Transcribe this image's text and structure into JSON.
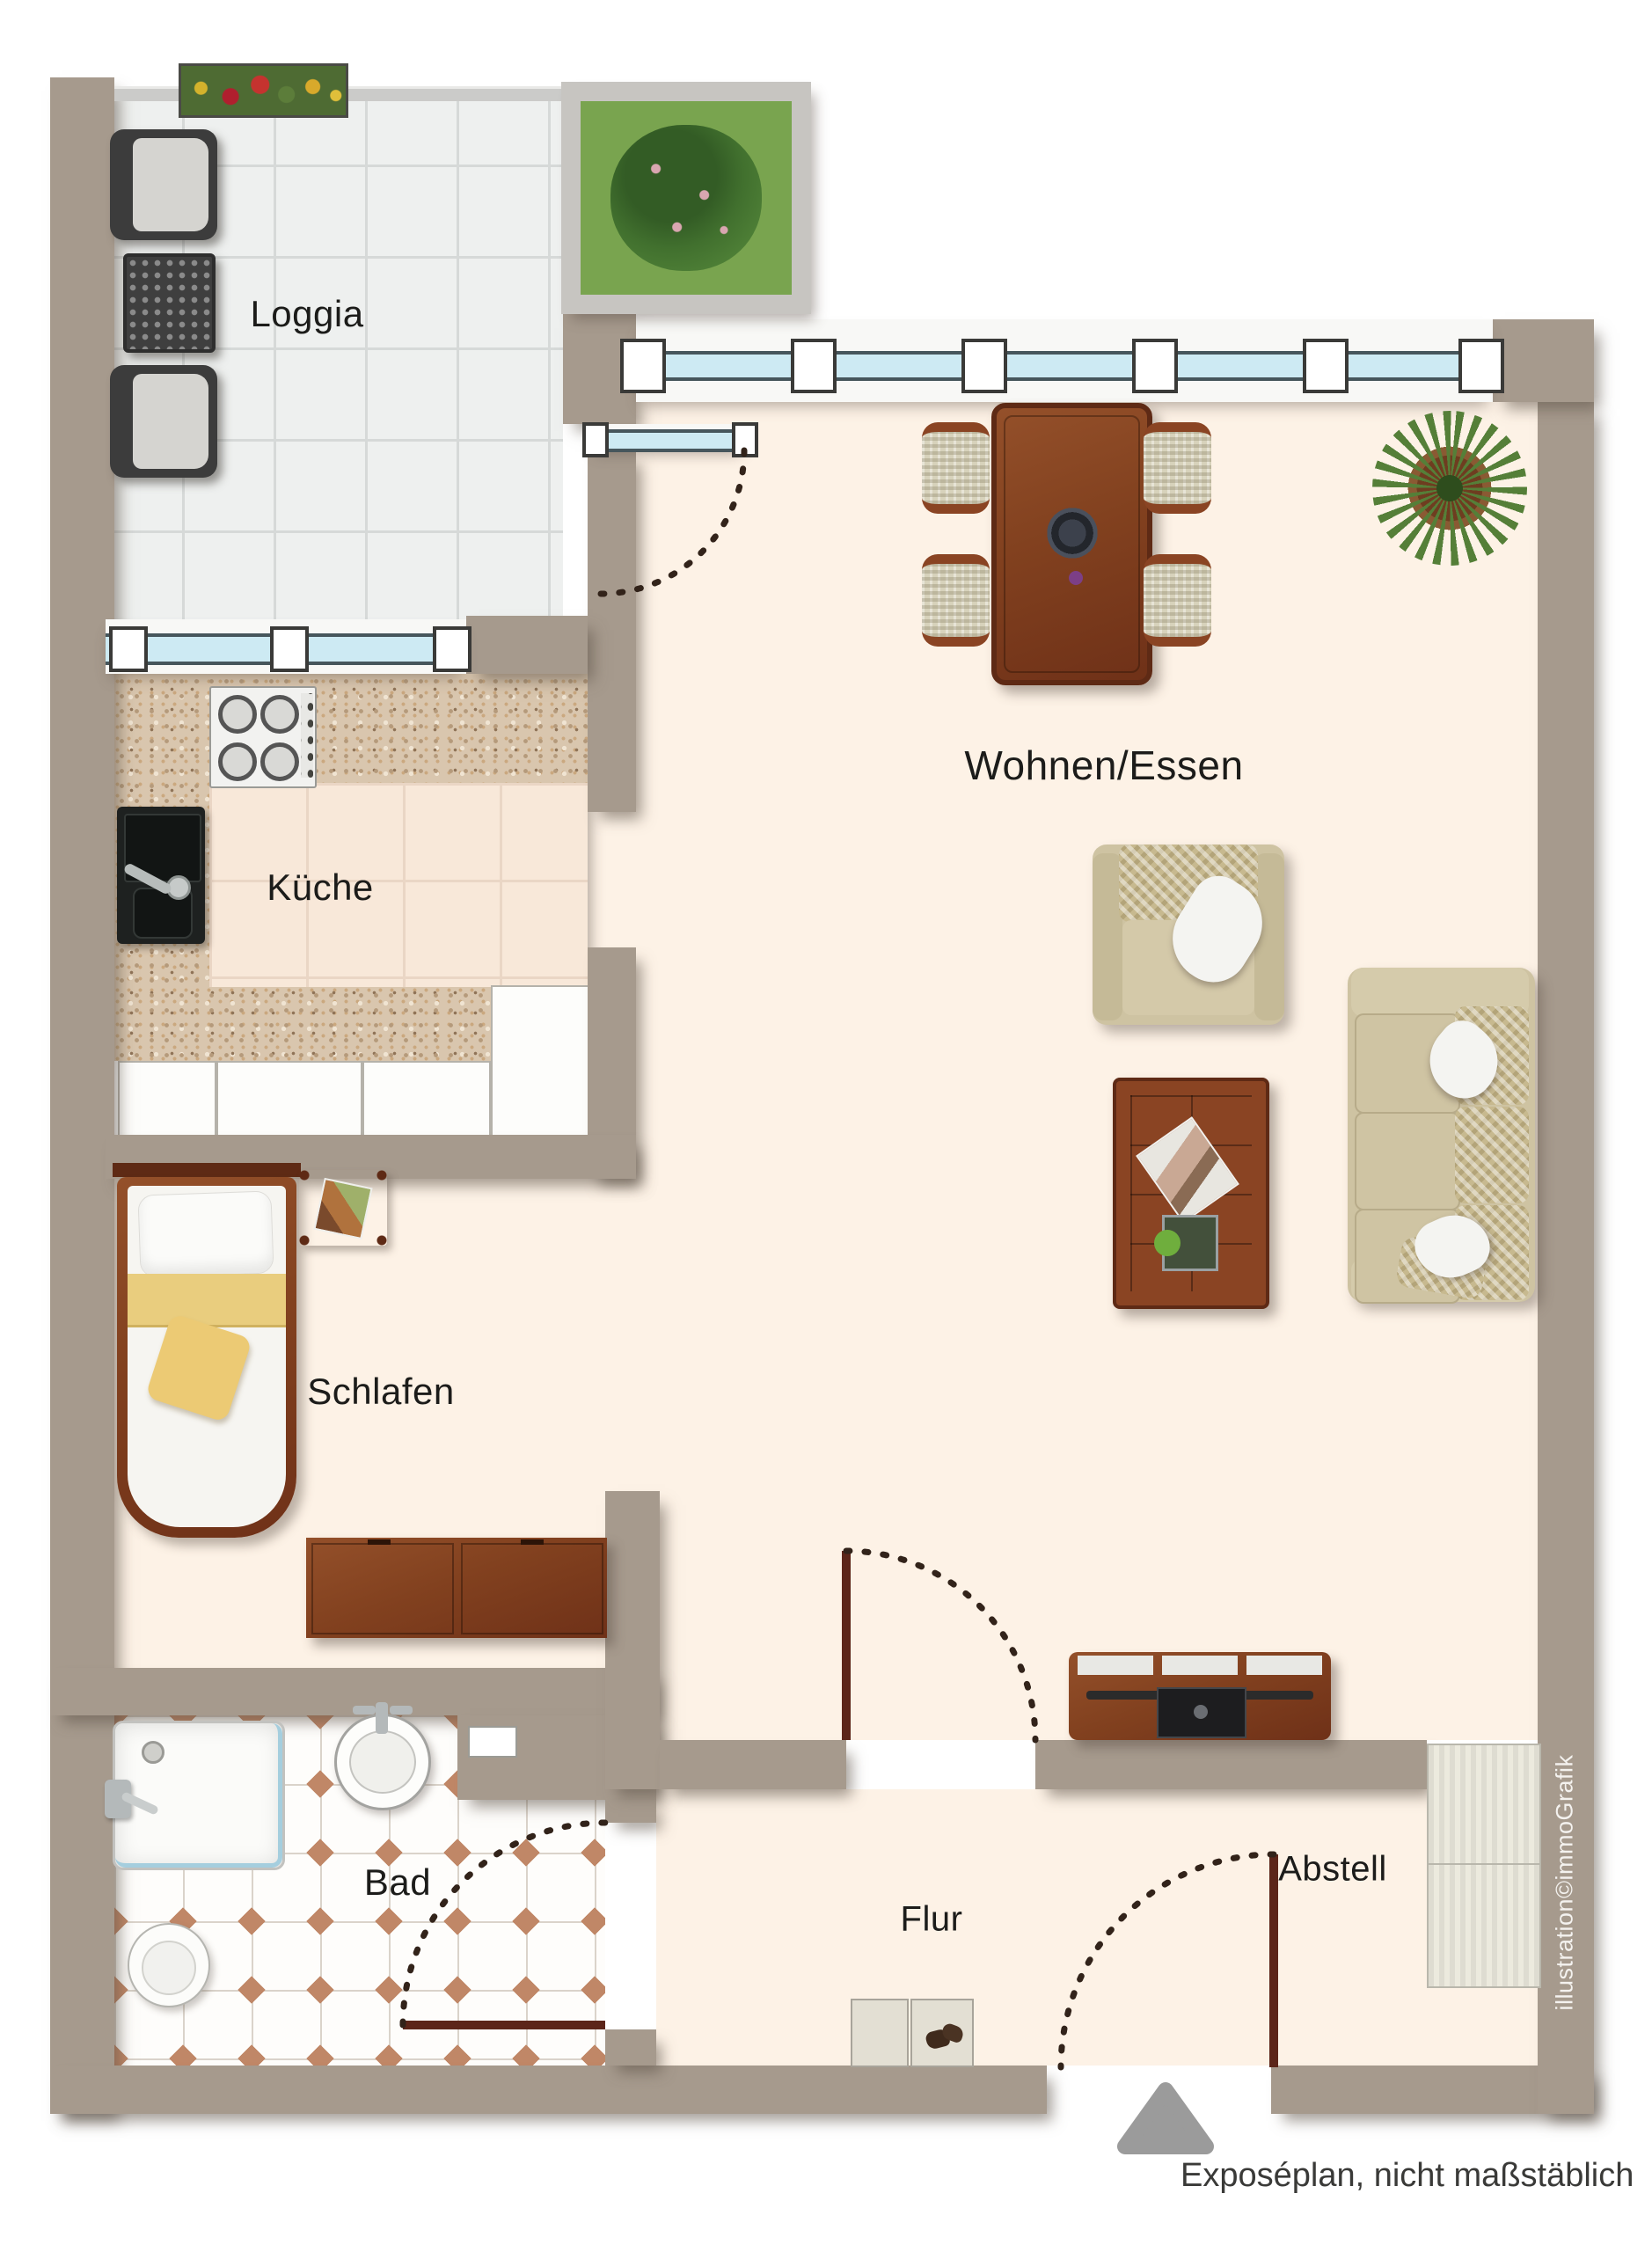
{
  "rooms": {
    "loggia": "Loggia",
    "kueche": "Küche",
    "wohnen_essen": "Wohnen/Essen",
    "schlafen": "Schlafen",
    "bad": "Bad",
    "flur": "Flur",
    "abstell": "Abstell"
  },
  "footer": {
    "caption": "Exposéplan, nicht maßstäblich"
  },
  "credit": "illustration©immoGrafik",
  "theme": {
    "wall": "#a69a8d",
    "floor": "#fdf2e6",
    "loggia_tile": "#eef0ef",
    "loggia_line": "#d6d9d8",
    "granite": "#d9c6ae",
    "kitchen_floor": "#f8e8d9",
    "kitchen_line": "#ead6c5",
    "bath_tile": "#fefdfb",
    "bath_line": "#dad3ca",
    "bath_diamond": "#c08767",
    "glass": "#cdeaf3",
    "glass_frame": "#46565c",
    "wood": "#82411f",
    "wood_deep": "#5e2a15",
    "fabric": "#cec3a2",
    "fabric_deep": "#bfb28c",
    "pillow": "#f4f4f1",
    "yellow": "#e9cd7e",
    "door_leaf": "#5c2519",
    "door_arc": "#32231a",
    "ink": "#1c1c1a",
    "caption_ink": "#3a3a38",
    "credit_ink": "#f4f2ef",
    "triangle": "#9b9b9b"
  },
  "symbols": {
    "entrance_marker": "triangle-arrow-icon",
    "door_swing": "dashed-quarter-arc",
    "window": "blue-glazing-band"
  },
  "furniture": {
    "loggia": [
      "outdoor-chair",
      "outdoor-table",
      "outdoor-chair",
      "flower-box",
      "planter-bed"
    ],
    "wohnen_essen": [
      "dining-table",
      "dining-chair x4",
      "potted-plant",
      "armchair",
      "coffee-table",
      "sofa",
      "tv-sideboard"
    ],
    "kueche": [
      "hob",
      "sink",
      "counter",
      "base-cabinets"
    ],
    "schlafen": [
      "single-bed",
      "nightstand",
      "dresser"
    ],
    "bad": [
      "shower",
      "washbasin",
      "toilet"
    ],
    "flur": [
      "shoe-rack"
    ],
    "abstell": [
      "built-in-closet"
    ]
  }
}
